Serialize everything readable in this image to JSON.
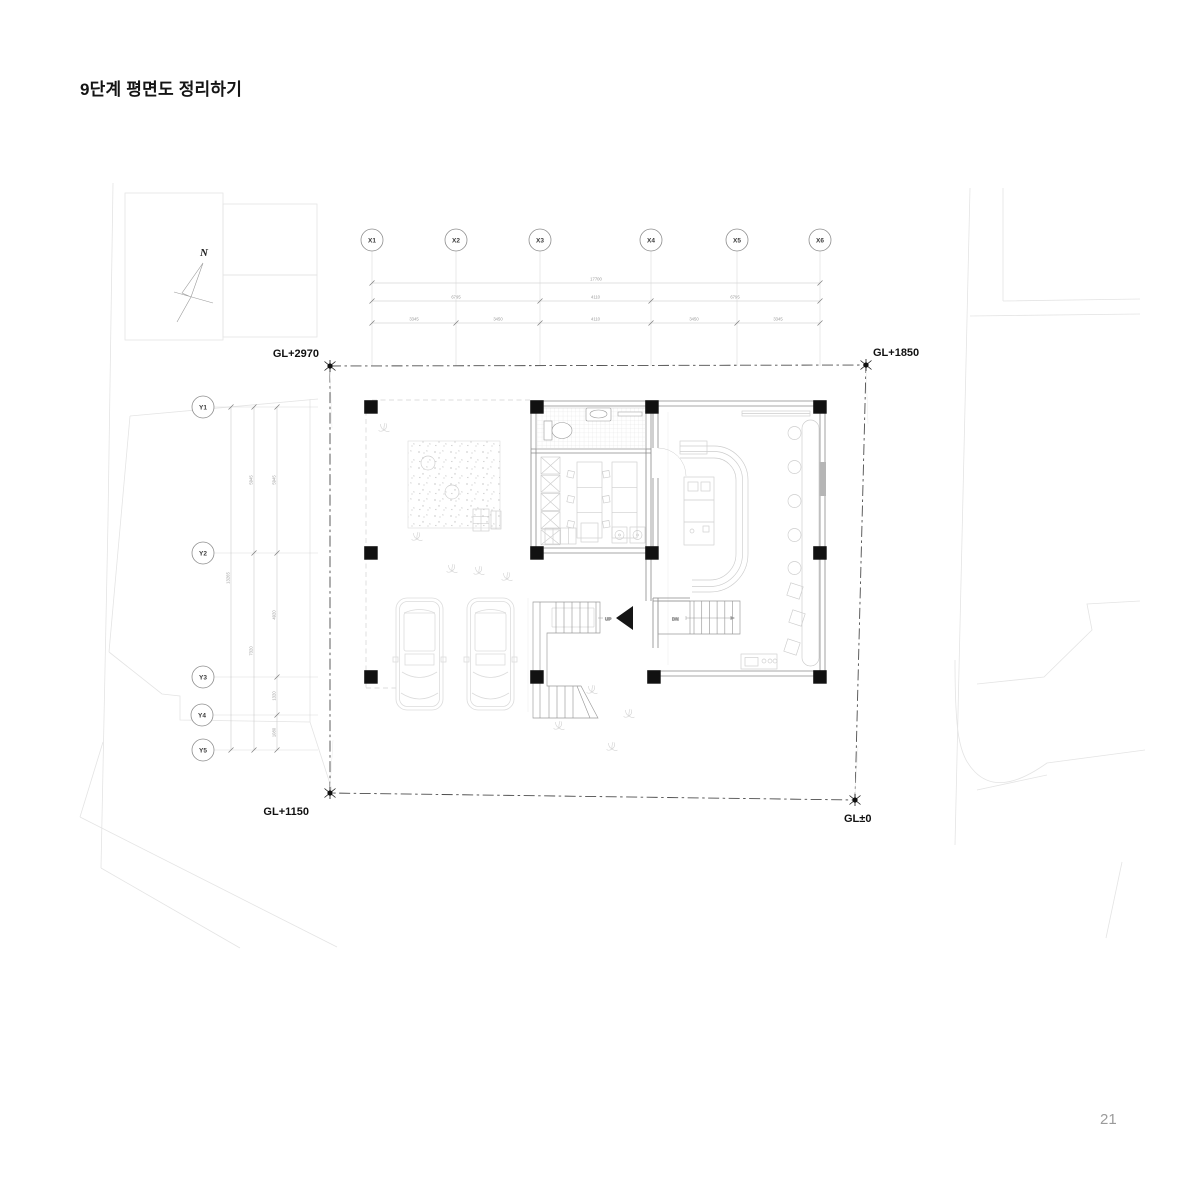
{
  "page": {
    "title": "9단계 평면도 정리하기",
    "number": "21"
  },
  "compass": {
    "label": "N"
  },
  "levels": {
    "top_left": "GL+2970",
    "top_right": "GL+1850",
    "bottom_left": "GL+1150",
    "bottom_right": "GL±0"
  },
  "grid": {
    "x": [
      "X1",
      "X2",
      "X3",
      "X4",
      "X5",
      "X6"
    ],
    "y": [
      "Y1",
      "Y2",
      "Y3",
      "Y4",
      "Y5"
    ]
  },
  "dimensions": {
    "x": {
      "total": "17700",
      "spans": [
        "6795",
        "4110",
        "6795"
      ],
      "segments": [
        "3345",
        "3450",
        "4110",
        "3450",
        "3345"
      ]
    },
    "y": {
      "total": "13265",
      "spans": [
        "5945",
        "7320"
      ],
      "segments": [
        "5945",
        "4920",
        "1320",
        "1080"
      ]
    }
  },
  "stairs": {
    "up": "UP",
    "down": "DN"
  },
  "colors": {
    "ink": "#141414",
    "boundary": "#4d4d4d",
    "wall": "#8a8a8a",
    "light_gray": "#d2d2d2",
    "context_gray": "#e4e4e4",
    "page_number": "#9b9b9b"
  }
}
